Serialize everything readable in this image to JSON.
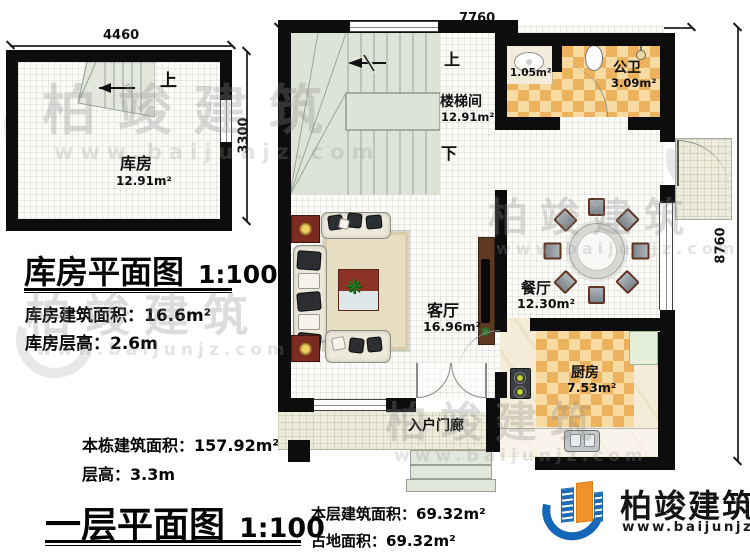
{
  "watermark": {
    "brand": "柏竣建筑",
    "url": "www.baijunjz.com"
  },
  "logo": {
    "brand": "柏竣建筑",
    "url": "www.baijunjz.com"
  },
  "icons": {
    "plant": "❋"
  },
  "storage_plan": {
    "title": "库房平面图",
    "scale": "1:100",
    "dims": {
      "width": "4460",
      "height": "3300"
    },
    "labels": {
      "up": "上"
    },
    "room": {
      "name": "库房",
      "area": "12.91m²"
    },
    "stats": [
      {
        "label": "库房建筑面积：",
        "value": "16.6m²"
      },
      {
        "label": "库房层高：",
        "value": "2.6m"
      }
    ]
  },
  "first_floor": {
    "title": "一层平面图",
    "scale": "1:100",
    "dims": {
      "width": "7760",
      "height": "8760"
    },
    "labels": {
      "up": "上",
      "down": "下"
    },
    "rooms": {
      "stairwell": {
        "name": "楼梯间",
        "area": "12.91m²"
      },
      "washroom": {
        "area": "1.05m²"
      },
      "bathroom": {
        "name": "公卫",
        "area": "3.09m²"
      },
      "dining": {
        "name": "餐厅",
        "area": "12.30m²"
      },
      "living": {
        "name": "客厅",
        "area": "16.96m²"
      },
      "kitchen": {
        "name": "厨房",
        "area": "7.53m²"
      },
      "porch": {
        "name": "入户门廊"
      }
    },
    "stats_building": [
      {
        "label": "本栋建筑面积：",
        "value": "157.92m²"
      },
      {
        "label": "层高：",
        "value": "3.3m"
      }
    ],
    "stats_floor": [
      {
        "label": "本层建筑面积：",
        "value": "69.32m²"
      },
      {
        "label": "占地面积：",
        "value": "69.32m²"
      }
    ]
  },
  "colors": {
    "wall": "#0d0d0d",
    "tile_orange": "#ecb25d",
    "tile_cream": "#f8dba3",
    "stair_floor": "#dde3d6",
    "accent_blue": "#1466b8",
    "accent_orange": "#f0922b"
  }
}
